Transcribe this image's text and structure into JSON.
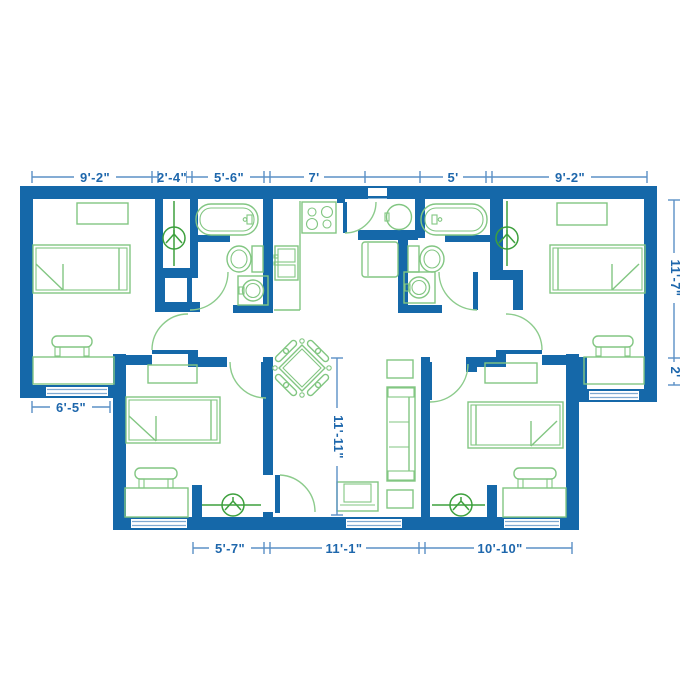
{
  "plan": {
    "type": "apartment-floor-plan",
    "units": "feet-inches"
  },
  "colors": {
    "wall_blue": "#1568a9",
    "furniture_green": "#82c682",
    "accent_green": "#3da03d",
    "door_arc_green": "#8ccb8c",
    "dimension_line_blue": "#5b90c6",
    "dimension_text_blue": "#1e67ac",
    "window_line_blue": "#7fa9d1",
    "background": "#ffffff"
  },
  "dimensions": {
    "top": [
      "9'-2\"",
      "2'-4\"",
      "5'-6\"",
      "7'",
      "5'",
      "9'-2\""
    ],
    "bottom": [
      "5'-7\"",
      "11'-1\"",
      "10'-10\""
    ],
    "left": [
      "6'-5\""
    ],
    "right": [
      "11'-7\"",
      "2'"
    ],
    "interior": [
      "11'-11\""
    ]
  }
}
